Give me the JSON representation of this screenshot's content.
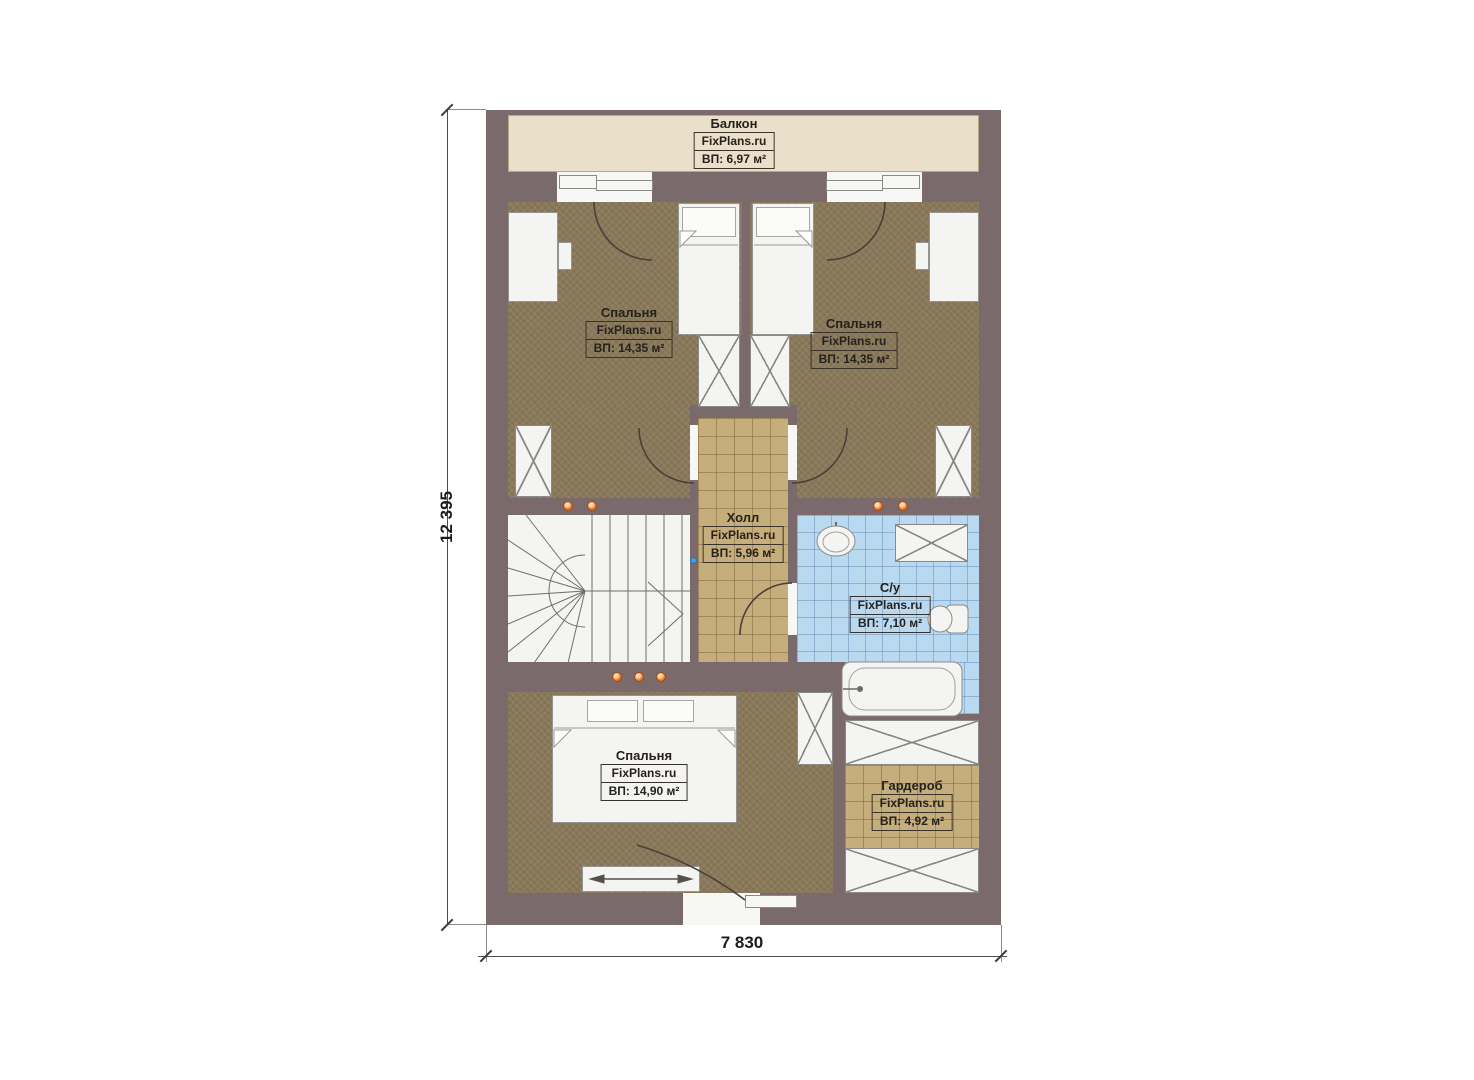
{
  "dimensions": {
    "height_total": "12 395",
    "width_total": "7 830"
  },
  "rooms": {
    "balcony": {
      "name": "Балкон",
      "brand": "FixPlans.ru",
      "area": "ВП: 6,97 м²"
    },
    "bedroom_left": {
      "name": "Спальня",
      "brand": "FixPlans.ru",
      "area": "ВП: 14,35 м²"
    },
    "bedroom_right": {
      "name": "Спальня",
      "brand": "FixPlans.ru",
      "area": "ВП: 14,35 м²"
    },
    "hall": {
      "name": "Холл",
      "brand": "FixPlans.ru",
      "area": "ВП: 5,96 м²"
    },
    "bathroom": {
      "name": "С/у",
      "brand": "FixPlans.ru",
      "area": "ВП: 7,10 м²"
    },
    "bedroom_master": {
      "name": "Спальня",
      "brand": "FixPlans.ru",
      "area": "ВП: 14,90 м²"
    },
    "wardrobe": {
      "name": "Гардероб",
      "brand": "FixPlans.ru",
      "area": "ВП: 4,92 м²"
    }
  },
  "colors": {
    "wall": "#7b6a6c",
    "bedroom_floor": "#8a795a",
    "hall_floor": "#c5ad7c",
    "wardrobe_floor": "#c5ad7c",
    "bathroom_floor": "#b9d9f1",
    "balcony_floor": "#eadfc8",
    "furniture": "#f4f4f2",
    "wall_light_dot": "#f07a2a",
    "marker_dot": "#4d9bd8"
  }
}
